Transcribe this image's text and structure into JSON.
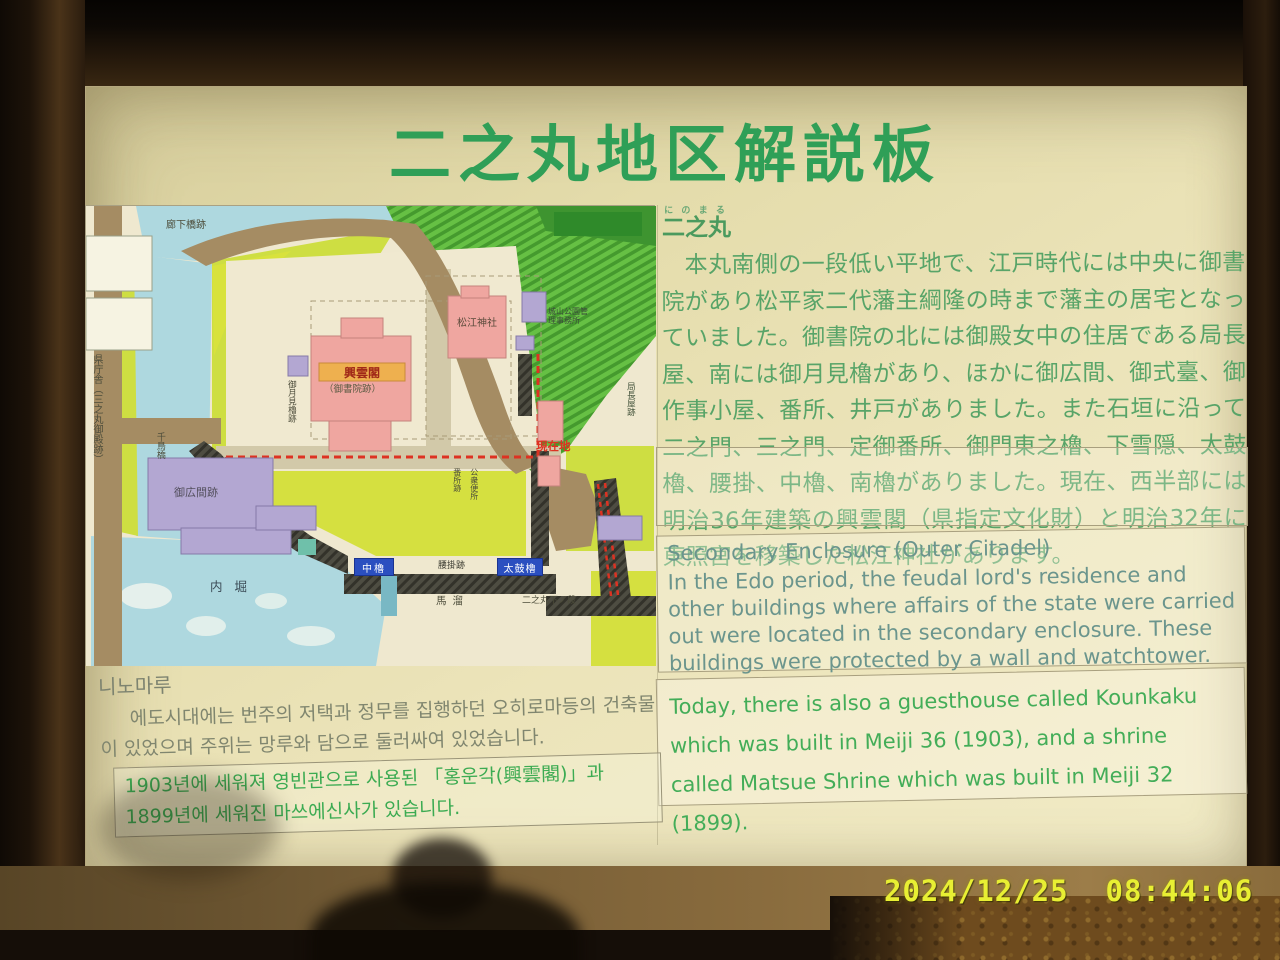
{
  "photo": {
    "timestamp": "2024/12/25  08:44:06"
  },
  "sign": {
    "title": "二之丸地区解説板",
    "japanese": {
      "heading": "二之丸",
      "heading_furigana": "にのまる",
      "body": "　本丸南側の一段低い平地で、江戸時代には中央に御書院があり松平家二代藩主綱隆の時まで藩主の居宅となっていました。御書院の北には御殿女中の住居である局長屋、南には御月見櫓があり、ほかに御広間、御式臺、御作事小屋、番所、井戸がありました。また石垣に沿って二之門、三之門、定御番所、御門東之櫓、下雪隠、太鼓櫓、腰掛、中櫓、南櫓がありました。現在、西半部には明治36年建築の興雲閣（県指定文化財）と明治32年に東照宮を移築した松江神社があります。"
    },
    "english": {
      "heading": "Secondary Enclosure (Outer Citadel)",
      "body": "In the Edo period, the feudal lord's residence and other buildings where affairs of the state were carried out were located in the secondary enclosure. These buildings were protected by a wall and watchtower.",
      "body2": "Today, there is also a guesthouse called Kounkaku which was built in Meiji 36 (1903), and a shrine called Matsue Shrine which was built in Meiji 32 (1899)."
    },
    "korean": {
      "heading": "니노마루",
      "body": "에도시대에는 번주의 저택과 정무를 집행하던 오히로마등의 건축물이 있었으며 주위는 망루와 담으로 둘러싸여 있었습니다.",
      "body2": "1903년에 세워져 영빈관으로 사용된 「홍운각(興雲閣)」과 1899년에 세워진 마쓰에신사가 있습니다."
    },
    "map": {
      "labels": {
        "corridor_bridge_site": "廊下橋跡",
        "prefectural_office": "県庁舎（三之丸御殿跡）",
        "chidori_bridge": "千鳥橋",
        "kounkaku": "興雲閣",
        "goshoin_site": "（御書院跡）",
        "matsue_shrine": "松江神社",
        "tsukimi_yagura_site": "御月見櫓跡",
        "tsubone_nagaya_site": "局長屋跡",
        "ohiroma_site": "御広間跡",
        "bansho_site": "番所跡",
        "public_toilet": "公衆便所",
        "park_office": "城山公園管理事務所",
        "current_location": "現在地",
        "naka_yagura": "中櫓",
        "taiko_yagura": "太鼓櫓",
        "koshikake_site": "腰掛跡",
        "inner_moat": "内堀",
        "horse_pool": "馬溜",
        "lower_terrace": "二之丸下ノ段"
      }
    }
  }
}
